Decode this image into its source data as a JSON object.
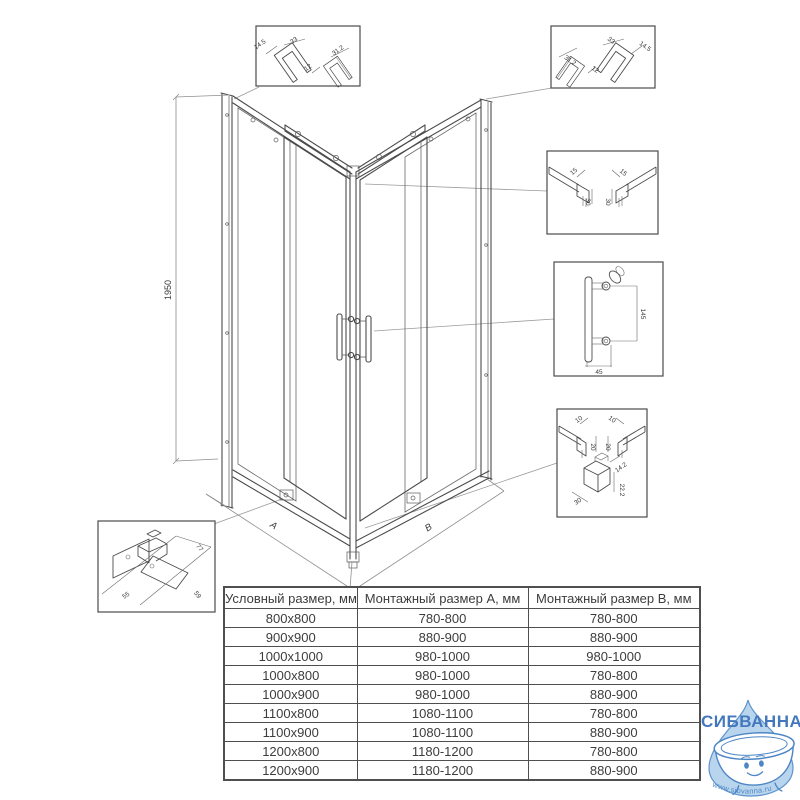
{
  "drawing": {
    "height_dim": "1950",
    "dim_a": "A",
    "dim_b": "B"
  },
  "callouts": {
    "top_left": {
      "d1": "14.5",
      "d2": "33",
      "d3": "12",
      "d4": "31.2"
    },
    "top_right": {
      "d1": "31.2",
      "d2": "12",
      "d3": "33",
      "d4": "14.5"
    },
    "wall_profile": {
      "d1": "15",
      "d2": "15",
      "d3": "30",
      "d4": "30"
    },
    "handle": {
      "d1": "145",
      "d2": "45"
    },
    "bottom_rail": {
      "d1": "10",
      "d2": "10",
      "d3": "20",
      "d4": "20",
      "d5": "14.2",
      "d6": "22.2",
      "d7": "30"
    },
    "roller": {
      "d1": "77",
      "d2": "55",
      "d3": "59"
    }
  },
  "table": {
    "headers": [
      "Условный размер, мм",
      "Монтажный размер A, мм",
      "Монтажный размер B, мм"
    ],
    "rows": [
      [
        "800x800",
        "780-800",
        "780-800"
      ],
      [
        "900x900",
        "880-900",
        "880-900"
      ],
      [
        "1000x1000",
        "980-1000",
        "980-1000"
      ],
      [
        "1000x800",
        "980-1000",
        "780-800"
      ],
      [
        "1000x900",
        "980-1000",
        "880-900"
      ],
      [
        "1100x800",
        "1080-1100",
        "780-800"
      ],
      [
        "1100x900",
        "1080-1100",
        "880-900"
      ],
      [
        "1200x800",
        "1180-1200",
        "780-800"
      ],
      [
        "1200x900",
        "1180-1200",
        "880-900"
      ]
    ]
  },
  "logo": {
    "brand": "СИБВАННА",
    "url": "www.sibvanna.ru",
    "colors": {
      "text": "#4478bc",
      "drop_fill": "#b9d5ee",
      "outline": "#5e93cd"
    }
  }
}
